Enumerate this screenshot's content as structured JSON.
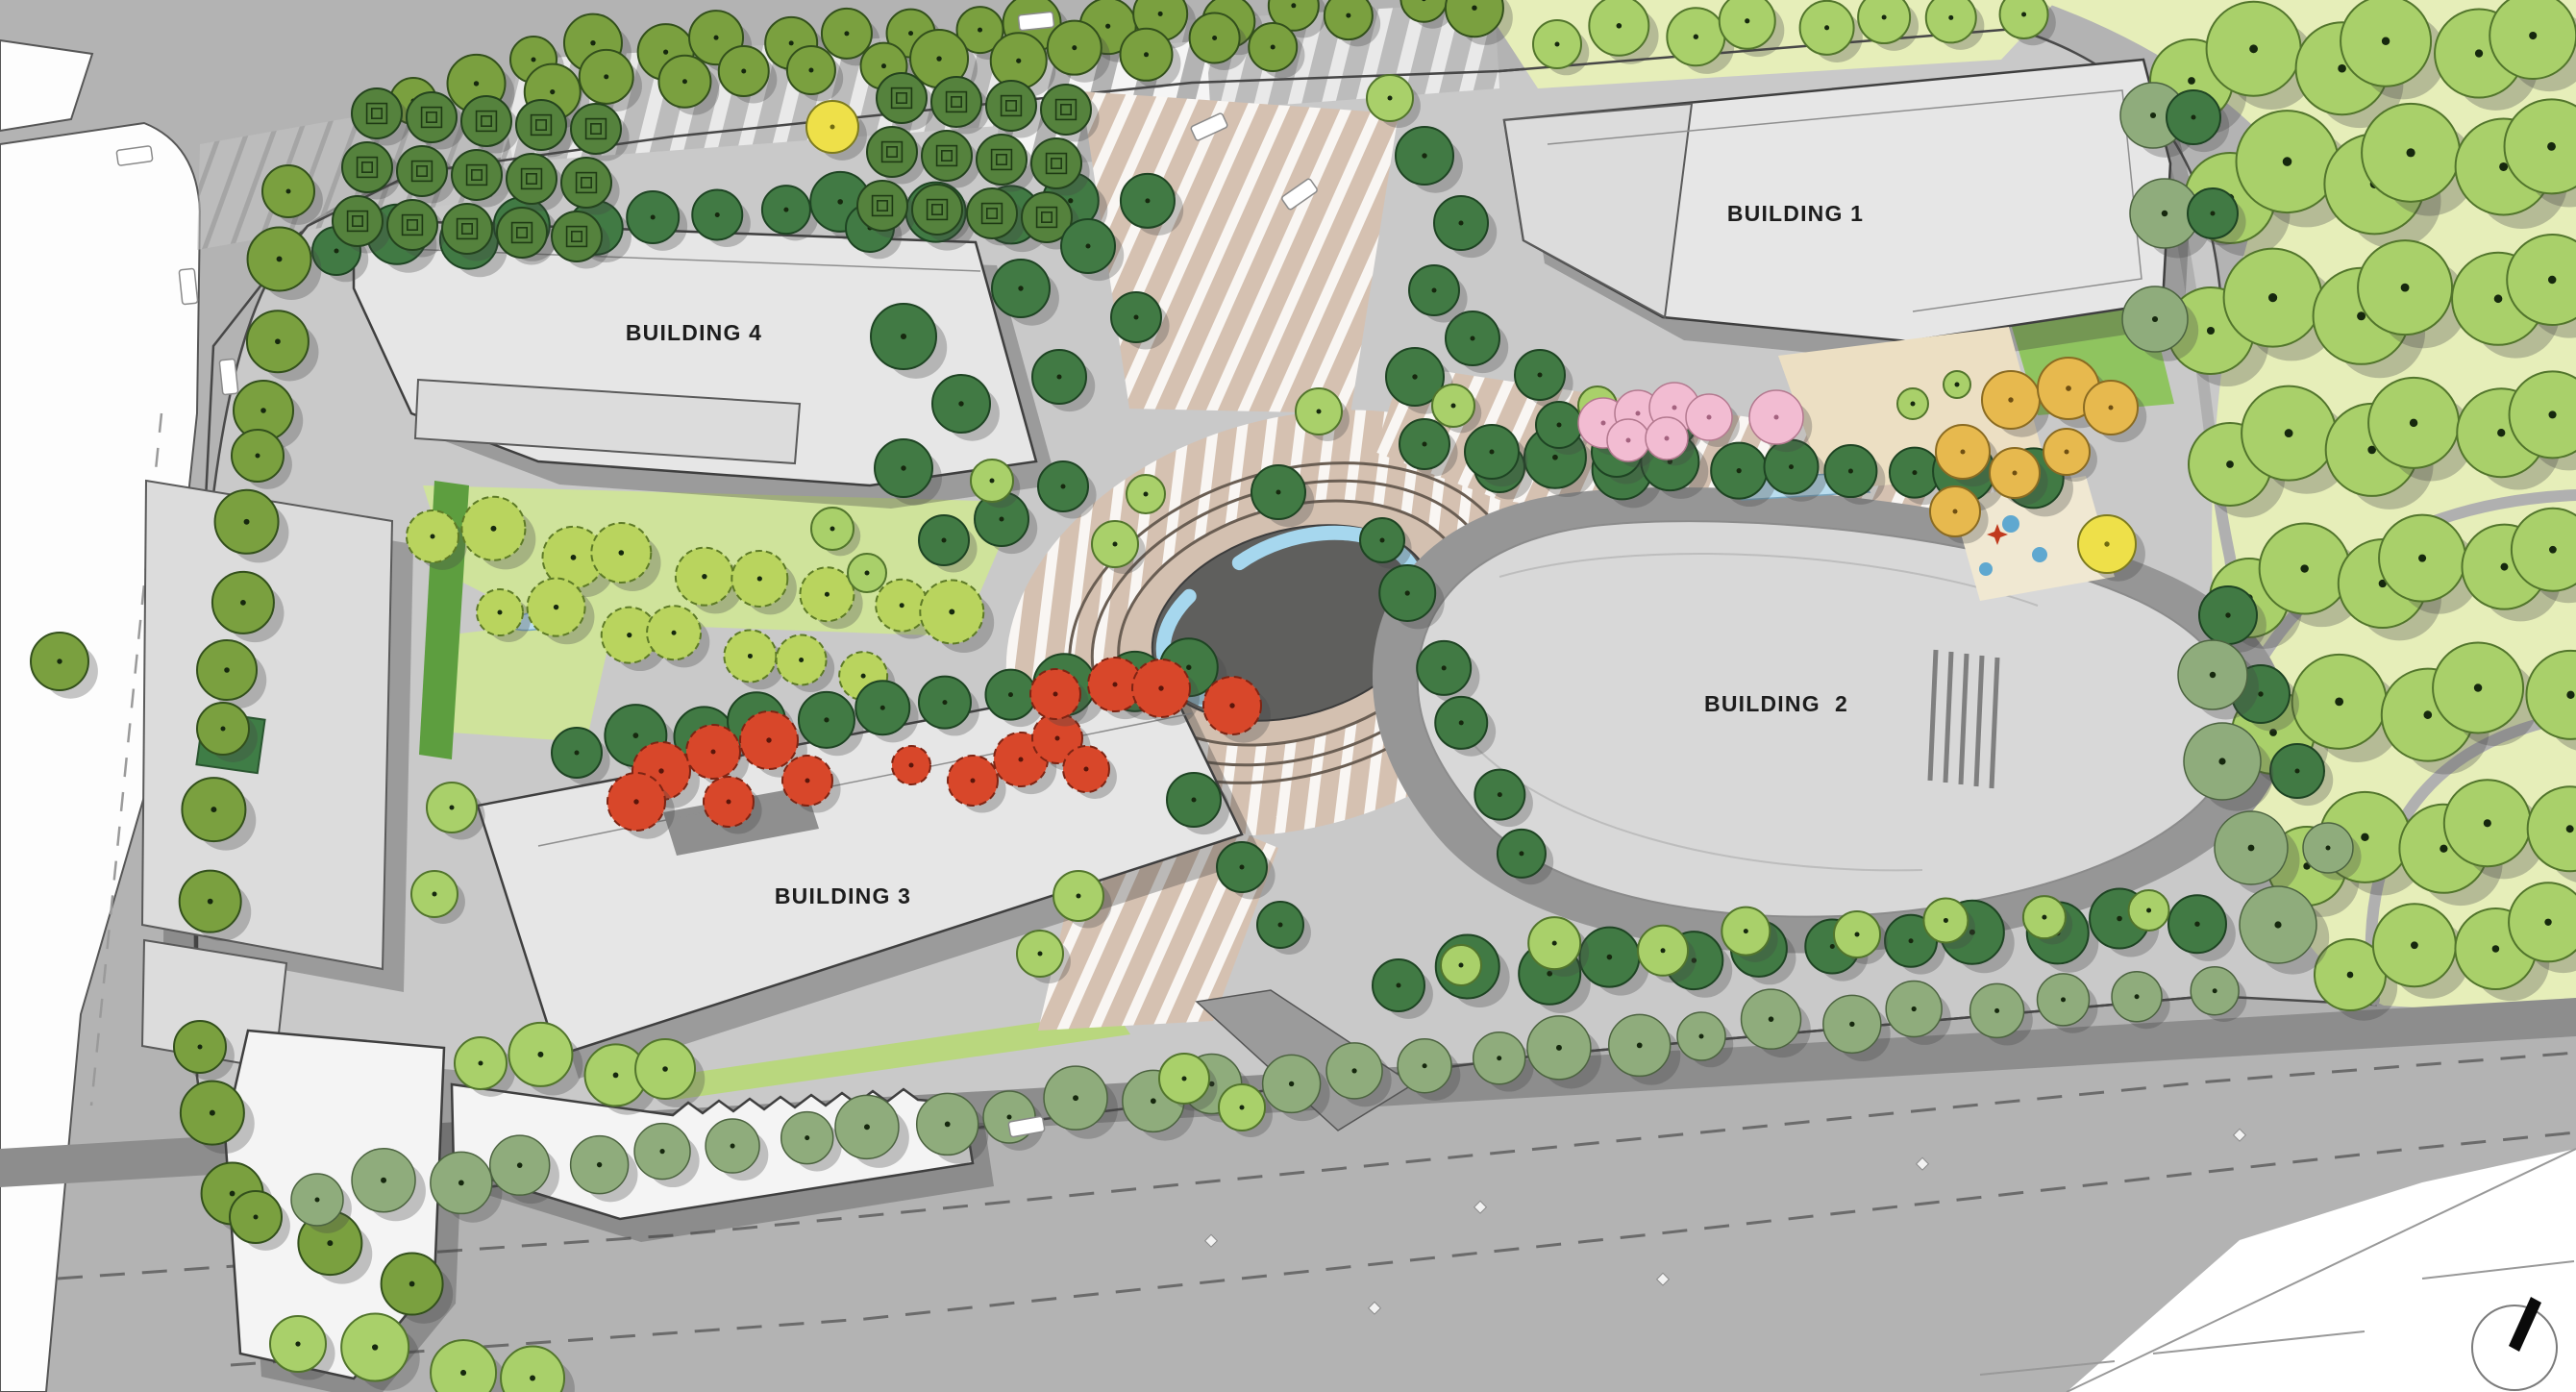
{
  "buildings": [
    {
      "name": "building-1",
      "label": "BUILDING 1"
    },
    {
      "name": "building-2",
      "label": "BUILDING  2"
    },
    {
      "name": "building-3",
      "label": "BUILDING 3"
    },
    {
      "name": "building-4",
      "label": "BUILDING 4"
    }
  ],
  "compass": {
    "description": "north-arrow"
  },
  "palette": {
    "road": "#b3b3b3",
    "road_dark": "#8d8d8d",
    "site": "#c9c9c9",
    "park_lawn": "#e6eeb9",
    "lawn_bright": "#cfe39b",
    "hedge": "#5d9e3f",
    "building_fill": "#e6e6e6",
    "building_outline": "#3f3f3f",
    "building2_band": "#969696",
    "paving_tan": "#d5c1b1",
    "plaza_dark": "#5f5f5d",
    "water": "#a6d7ee",
    "tree_olive": "#7aa03f",
    "tree_dark": "#417a44",
    "tree_light": "#a9d06a",
    "tree_sage": "#8fac7c",
    "tree_red": "#d8472a",
    "tree_pink": "#f2bcd2",
    "tree_orange": "#e7b94e",
    "tree_yellow": "#eee049"
  }
}
